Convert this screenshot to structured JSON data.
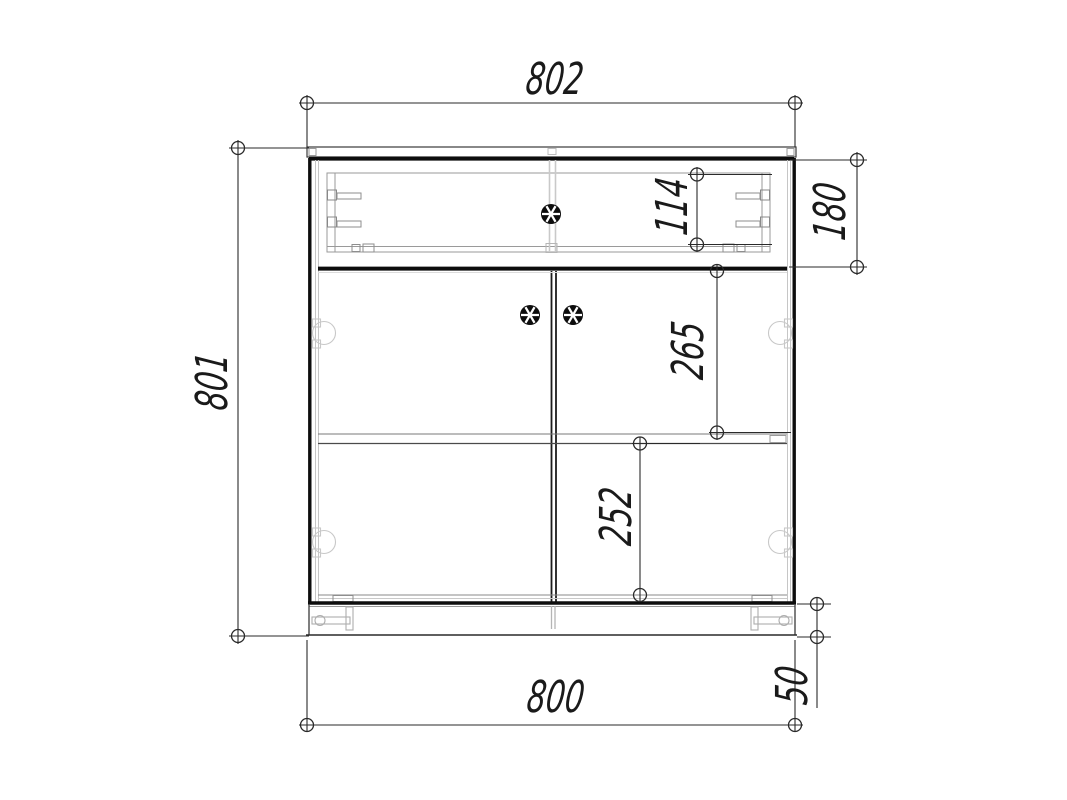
{
  "page": {
    "title": "Cabinet front view dimension drawing",
    "background_color": "#ffffff",
    "line_color": "#141414",
    "dim_line_color": "#2a2a2a",
    "light_line_color": "#c6c6c6",
    "units": "mm"
  },
  "drawing": {
    "type": "orthographic-front-view",
    "object": "two-door cabinet with top drawer and plinth",
    "parts": [
      {
        "name": "top-panel"
      },
      {
        "name": "drawer-section"
      },
      {
        "name": "drawer-knob",
        "icon": "spoked-wheel-knob-icon"
      },
      {
        "name": "left-door"
      },
      {
        "name": "right-door"
      },
      {
        "name": "door-knobs",
        "icon": "spoked-wheel-knob-icon"
      },
      {
        "name": "hinge-cups",
        "icon": "hinge-circle-icon"
      },
      {
        "name": "shelf"
      },
      {
        "name": "plinth"
      },
      {
        "name": "adjustable-feet",
        "icon": "leveler-foot-icon"
      }
    ],
    "dimensions": [
      {
        "id": "top-width",
        "label": "802",
        "value": 802,
        "orientation": "horizontal",
        "measures": "overall top panel width"
      },
      {
        "id": "overall-height",
        "label": "801",
        "value": 801,
        "orientation": "vertical",
        "measures": "overall cabinet height"
      },
      {
        "id": "drawer-box-height",
        "label": "114",
        "value": 114,
        "orientation": "vertical",
        "measures": "drawer box inner height"
      },
      {
        "id": "drawer-section",
        "label": "180",
        "value": 180,
        "orientation": "vertical",
        "measures": "drawer section height"
      },
      {
        "id": "upper-compartment",
        "label": "265",
        "value": 265,
        "orientation": "vertical",
        "measures": "divider to shelf spacing"
      },
      {
        "id": "lower-compartment",
        "label": "252",
        "value": 252,
        "orientation": "vertical",
        "measures": "shelf to bottom spacing"
      },
      {
        "id": "body-width",
        "label": "800",
        "value": 800,
        "orientation": "horizontal",
        "measures": "cabinet body width"
      },
      {
        "id": "plinth-height",
        "label": "50",
        "value": 50,
        "orientation": "vertical",
        "measures": "plinth height"
      }
    ]
  }
}
